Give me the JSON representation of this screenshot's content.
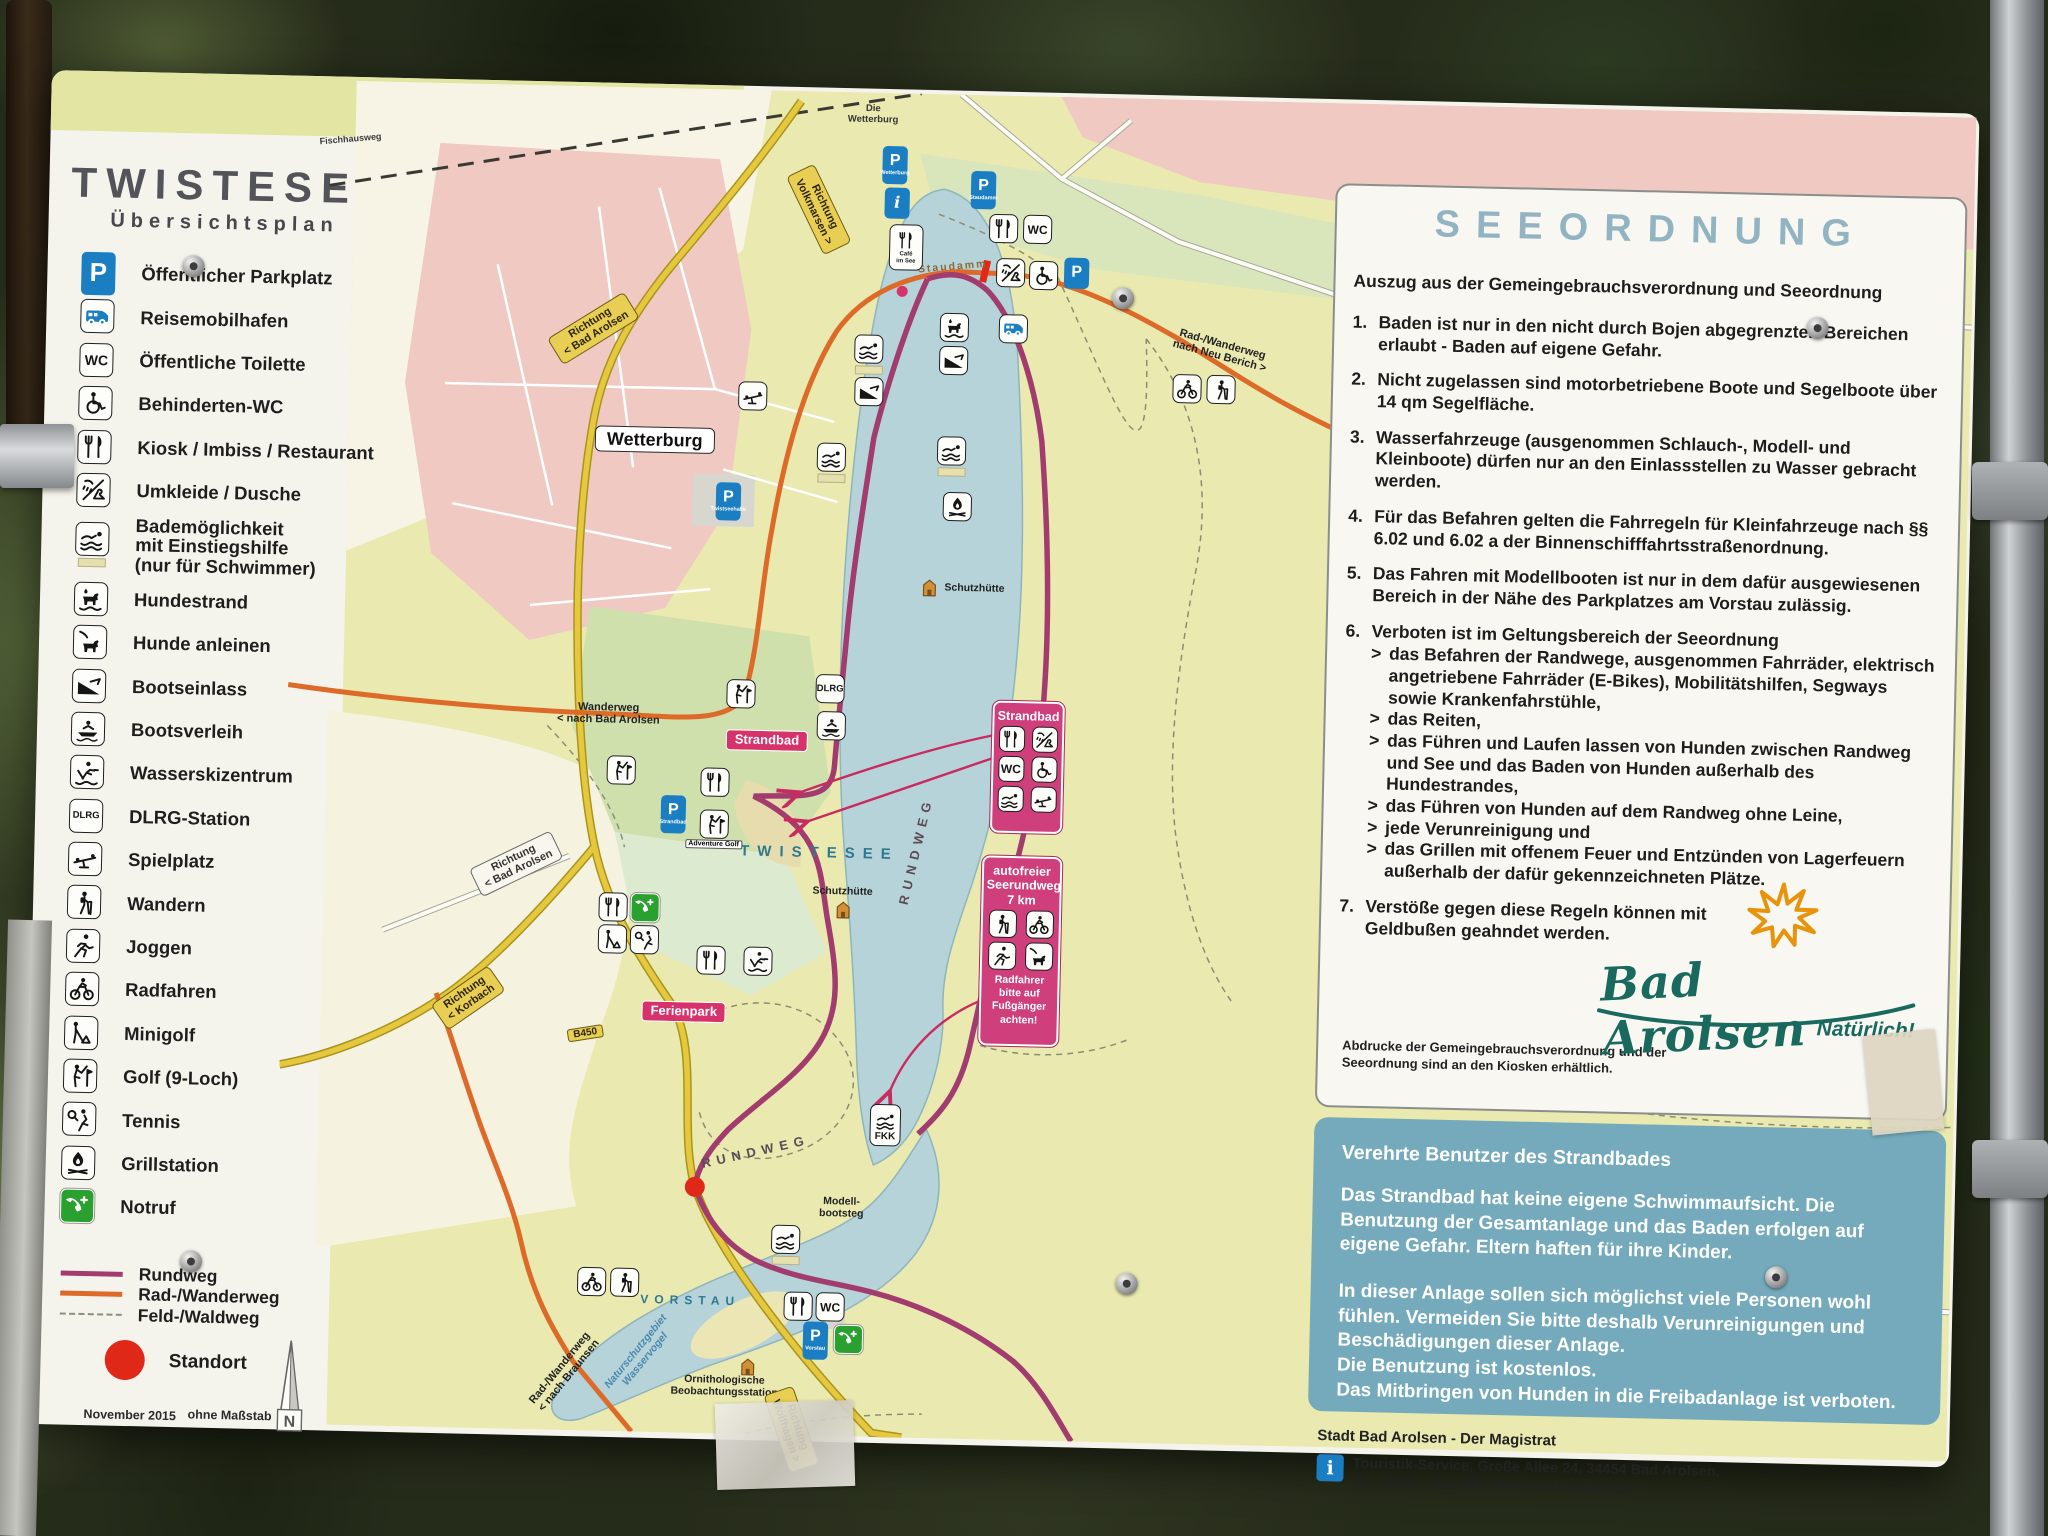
{
  "sign": {
    "title": "TWISTESEE",
    "subtitle": "Übersichtsplan",
    "notes": {
      "date": "November 2015",
      "scale": "ohne Maßstab",
      "standort": "Standort",
      "north": "N"
    }
  },
  "legend": {
    "items": [
      {
        "icon": "parking",
        "label": "Öffentlicher Parkplatz"
      },
      {
        "icon": "rv",
        "label": "Reisemobilhafen"
      },
      {
        "icon": "wc",
        "label": "Öffentliche Toilette"
      },
      {
        "icon": "wheelchair",
        "label": "Behinderten-WC"
      },
      {
        "icon": "restaurant",
        "label": "Kiosk / Imbiss / Restaurant"
      },
      {
        "icon": "shower",
        "label": "Umkleide / Dusche"
      },
      {
        "icon": "swim-access",
        "label": "Bademöglichkeit\nmit Einstiegshilfe\n(nur für Schwimmer)",
        "tall": true
      },
      {
        "icon": "dog-beach",
        "label": "Hundestrand"
      },
      {
        "icon": "dog-leash",
        "label": "Hunde anleinen"
      },
      {
        "icon": "boat-ramp",
        "label": "Bootseinlass"
      },
      {
        "icon": "boat",
        "label": "Bootsverleih"
      },
      {
        "icon": "waterski",
        "label": "Wasserskizentrum"
      },
      {
        "icon": "dlrg",
        "label": "DLRG-Station"
      },
      {
        "icon": "playground",
        "label": "Spielplatz"
      },
      {
        "icon": "hiker",
        "label": "Wandern"
      },
      {
        "icon": "jogger",
        "label": "Joggen"
      },
      {
        "icon": "cyclist",
        "label": "Radfahren"
      },
      {
        "icon": "minigolf",
        "label": "Minigolf"
      },
      {
        "icon": "golfer",
        "label": "Golf (9-Loch)"
      },
      {
        "icon": "tennis",
        "label": "Tennis"
      },
      {
        "icon": "grill",
        "label": "Grillstation"
      },
      {
        "icon": "phone",
        "label": "Notruf"
      }
    ],
    "routes": [
      {
        "label": "Rundweg",
        "color": "#a23c6f",
        "style": "solid"
      },
      {
        "label": "Rad-/Wanderweg",
        "color": "#dd6a28",
        "style": "solid"
      },
      {
        "label": "Feld-/Waldweg",
        "color": "#8d8d7c",
        "style": "dashed"
      }
    ]
  },
  "map": {
    "labels": [
      {
        "text": "Fischhausweg",
        "x": 50,
        "y": 58,
        "cls": "tiny",
        "rot": -6
      },
      {
        "text": "Die\nWetterburg",
        "x": 572,
        "y": 22,
        "cls": "tinyc"
      },
      {
        "text": "Richtung\nVolkmarsen >",
        "x": 520,
        "y": 118,
        "cls": "roadY",
        "rot": 63
      },
      {
        "text": "Richtung\n< Bad Arolsen",
        "x": 297,
        "y": 242,
        "cls": "roadY",
        "rot": -33
      },
      {
        "text": "Staudamm",
        "x": 655,
        "y": 173,
        "cls": "brown",
        "rot": -6
      },
      {
        "text": "Rad-/Wanderweg\nnach Neu Berich >",
        "x": 925,
        "y": 250,
        "cls": "dark",
        "rot": 14
      },
      {
        "text": "Wetterburg",
        "x": 361,
        "y": 352,
        "cls": "town"
      },
      {
        "text": "Schutzhütte",
        "x": 684,
        "y": 494,
        "cls": "darkc"
      },
      {
        "text": "Wanderweg\n< nach Bad Arolsen",
        "x": 321,
        "y": 627,
        "cls": "dark"
      },
      {
        "text": "Strandbad",
        "x": 480,
        "y": 650,
        "cls": "pink"
      },
      {
        "text": "TWISTESEE",
        "x": 535,
        "y": 762,
        "cls": "lakebig"
      },
      {
        "text": "RUNDWEG",
        "x": 632,
        "y": 757,
        "cls": "path",
        "rot": -78
      },
      {
        "text": "Schutzhütte",
        "x": 559,
        "y": 800,
        "cls": "darkc"
      },
      {
        "text": "Richtung\n< Bad Arolsen",
        "x": 232,
        "y": 779,
        "cls": "roadW",
        "rot": -27
      },
      {
        "text": "Ferienpark",
        "x": 403,
        "y": 923,
        "cls": "pink"
      },
      {
        "text": "Richtung\n< Korbach",
        "x": 187,
        "y": 914,
        "cls": "roadY",
        "rot": -36
      },
      {
        "text": "B450",
        "x": 305,
        "y": 947,
        "cls": "b450",
        "rot": -10
      },
      {
        "text": "RUNDWEG",
        "x": 478,
        "y": 1062,
        "cls": "path",
        "rot": -14
      },
      {
        "text": "Modell-\nbootsteg",
        "x": 565,
        "y": 1116,
        "cls": "darkc"
      },
      {
        "text": "VORSTAU",
        "x": 416,
        "y": 1212,
        "cls": "lake"
      },
      {
        "text": "Naturschutzgebiet\nWasservogel",
        "x": 368,
        "y": 1268,
        "cls": "bluerot",
        "rot": -52
      },
      {
        "text": "Rad-/Wanderweg\n< nach Braunsen",
        "x": 292,
        "y": 1286,
        "cls": "dark",
        "rot": -52
      },
      {
        "text": "Ornithologische\nBeobachtungsstation",
        "x": 452,
        "y": 1297,
        "cls": "darkc"
      },
      {
        "text": "Richtung\nWolfhagen >",
        "x": 520,
        "y": 1338,
        "cls": "roadY",
        "rot": 70
      }
    ],
    "markers": [
      {
        "icon": "parking",
        "x": 595,
        "y": 72,
        "sub": "Wetterburg"
      },
      {
        "icon": "info",
        "x": 598,
        "y": 110
      },
      {
        "icon": "parking",
        "x": 684,
        "y": 95,
        "sub": "Staudamm"
      },
      {
        "icon": "restaurant",
        "x": 705,
        "y": 133
      },
      {
        "icon": "wc",
        "x": 739,
        "y": 133
      },
      {
        "icon": "shower",
        "x": 713,
        "y": 177
      },
      {
        "icon": "wheelchair",
        "x": 746,
        "y": 179
      },
      {
        "icon": "parking",
        "x": 779,
        "y": 176
      },
      {
        "icon": "cafe",
        "x": 608,
        "y": 154
      },
      {
        "icon": "rv",
        "x": 717,
        "y": 233
      },
      {
        "icon": "dog-beach",
        "x": 658,
        "y": 233
      },
      {
        "icon": "boat-ramp",
        "x": 658,
        "y": 266
      },
      {
        "icon": "swimmer-bar",
        "x": 573,
        "y": 262
      },
      {
        "icon": "boat-ramp",
        "x": 574,
        "y": 299
      },
      {
        "icon": "cyclist",
        "x": 892,
        "y": 289
      },
      {
        "icon": "hiker",
        "x": 926,
        "y": 289
      },
      {
        "icon": "playground",
        "x": 458,
        "y": 306
      },
      {
        "icon": "parking",
        "x": 436,
        "y": 412,
        "sub": "Twistseehalle"
      },
      {
        "icon": "swimmer-bar",
        "x": 658,
        "y": 362
      },
      {
        "icon": "swimmer-bar",
        "x": 538,
        "y": 371
      },
      {
        "icon": "grill",
        "x": 665,
        "y": 412
      },
      {
        "icon": "hut",
        "x": 639,
        "y": 494
      },
      {
        "icon": "golfer",
        "x": 453,
        "y": 604
      },
      {
        "icon": "dlrg",
        "x": 542,
        "y": 597
      },
      {
        "icon": "boat",
        "x": 544,
        "y": 634
      },
      {
        "icon": "golfer",
        "x": 335,
        "y": 683
      },
      {
        "icon": "parking",
        "x": 388,
        "y": 726,
        "sub": "Strandbad"
      },
      {
        "icon": "restaurant",
        "x": 429,
        "y": 693
      },
      {
        "icon": "golfer",
        "x": 429,
        "y": 740,
        "sub2": "Adventure Golf"
      },
      {
        "icon": "hut",
        "x": 560,
        "y": 818
      },
      {
        "icon": "restaurant",
        "x": 330,
        "y": 820
      },
      {
        "icon": "phone",
        "x": 362,
        "y": 820
      },
      {
        "icon": "minigolf",
        "x": 330,
        "y": 852
      },
      {
        "icon": "tennis",
        "x": 362,
        "y": 852
      },
      {
        "icon": "restaurant",
        "x": 429,
        "y": 871
      },
      {
        "icon": "waterski",
        "x": 476,
        "y": 871
      },
      {
        "icon": "fkk",
        "x": 607,
        "y": 1032
      },
      {
        "icon": "swimmer-bar",
        "x": 510,
        "y": 1154
      },
      {
        "icon": "cyclist",
        "x": 317,
        "y": 1195
      },
      {
        "icon": "hiker",
        "x": 350,
        "y": 1195
      },
      {
        "icon": "hut",
        "x": 475,
        "y": 1277
      },
      {
        "icon": "restaurant",
        "x": 524,
        "y": 1215
      },
      {
        "icon": "wc",
        "x": 556,
        "y": 1215
      },
      {
        "icon": "parking",
        "x": 542,
        "y": 1249,
        "sub": "Vorstau"
      },
      {
        "icon": "phone",
        "x": 575,
        "y": 1247
      }
    ],
    "callouts": {
      "strandbad": {
        "title": "Strandbad",
        "icons": [
          "restaurant",
          "shower",
          "wc",
          "wheelchair",
          "swimmer",
          "playground"
        ]
      },
      "seerundweg": {
        "title": "autofreier\nSeerundweg\n7 km",
        "icons": [
          "hiker",
          "cyclist",
          "jogger",
          "dog-leash"
        ],
        "note": "Radfahrer\nbitte auf\nFußgänger\nachten!"
      }
    }
  },
  "seeordnung": {
    "title": "SEEORDNUNG",
    "intro": "Auszug aus der Gemeingebrauchsverordnung und Seeordnung",
    "rules": [
      {
        "n": "1.",
        "t": "Baden ist nur in den nicht durch Bojen abgegrenzten Bereichen erlaubt - Baden auf eigene Gefahr."
      },
      {
        "n": "2.",
        "t": "Nicht zugelassen sind motorbetriebene Boote und Segelboote über 14 qm Segelfläche."
      },
      {
        "n": "3.",
        "t": "Wasserfahrzeuge (ausgenommen Schlauch-, Modell- und Kleinboote) dürfen nur an den Einlassstellen zu Wasser gebracht werden."
      },
      {
        "n": "4.",
        "t": "Für das Befahren gelten die Fahrregeln für Kleinfahrzeuge nach §§ 6.02 und 6.02 a der Binnenschifffahrtsstraßenordnung."
      },
      {
        "n": "5.",
        "t": "Das Fahren mit Modellbooten ist nur in dem dafür ausgewiesenen Bereich in der Nähe des Parkplatzes am Vorstau zulässig."
      },
      {
        "n": "6.",
        "t": "Verboten ist im Geltungsbereich der Seeordnung",
        "sub": [
          "das Befahren der Randwege, ausgenommen Fahrräder, elektrisch angetriebene Fahrräder (E-Bikes), Mobilitätshilfen, Segways sowie Krankenfahrstühle,",
          "das Reiten,",
          "das Führen und Laufen lassen von Hunden zwischen Randweg und See und das Baden von Hunden außerhalb des Hundestrandes,",
          "das Führen von Hunden auf dem Randweg ohne Leine,",
          "jede Verunreinigung und",
          "das Grillen mit offenem Feuer und Entzünden von Lagerfeuern außerhalb der dafür gekennzeichneten Plätze."
        ]
      },
      {
        "n": "7.",
        "t": "Verstöße gegen diese Regeln können mit Geldbußen geahndet werden."
      }
    ],
    "footnote": "Abdrucke der Gemeingebrauchsverordnung und der Seeordnung sind an den Kiosken erhältlich.",
    "logo": {
      "name": "Bad Arolsen",
      "tagline": "Natürlich!"
    }
  },
  "notice": {
    "title": "Verehrte Benutzer des Strandbades",
    "paragraphs": [
      "Das Strandbad hat keine eigene Schwimmaufsicht. Die Benutzung der Gesamtanlage und das Baden erfolgen auf eigene Gefahr. Eltern haften für ihre Kinder.",
      "In dieser Anlage sollen sich möglichst viele Personen wohl fühlen. Vermeiden Sie bitte deshalb Verunreinigungen und Beschädigungen dieser Anlage.",
      "Die Benutzung ist kostenlos.",
      "Das Mitbringen von Hunden in die Freibadanlage ist verboten."
    ]
  },
  "footer": {
    "line1": "Stadt Bad Arolsen - Der Magistrat",
    "line2": "Touristik-Service, Große Allee 24, 34454 Bad Arolsen,",
    "line3": "Tel. 05691 / 801-240, www.bad-arolsen.de"
  }
}
